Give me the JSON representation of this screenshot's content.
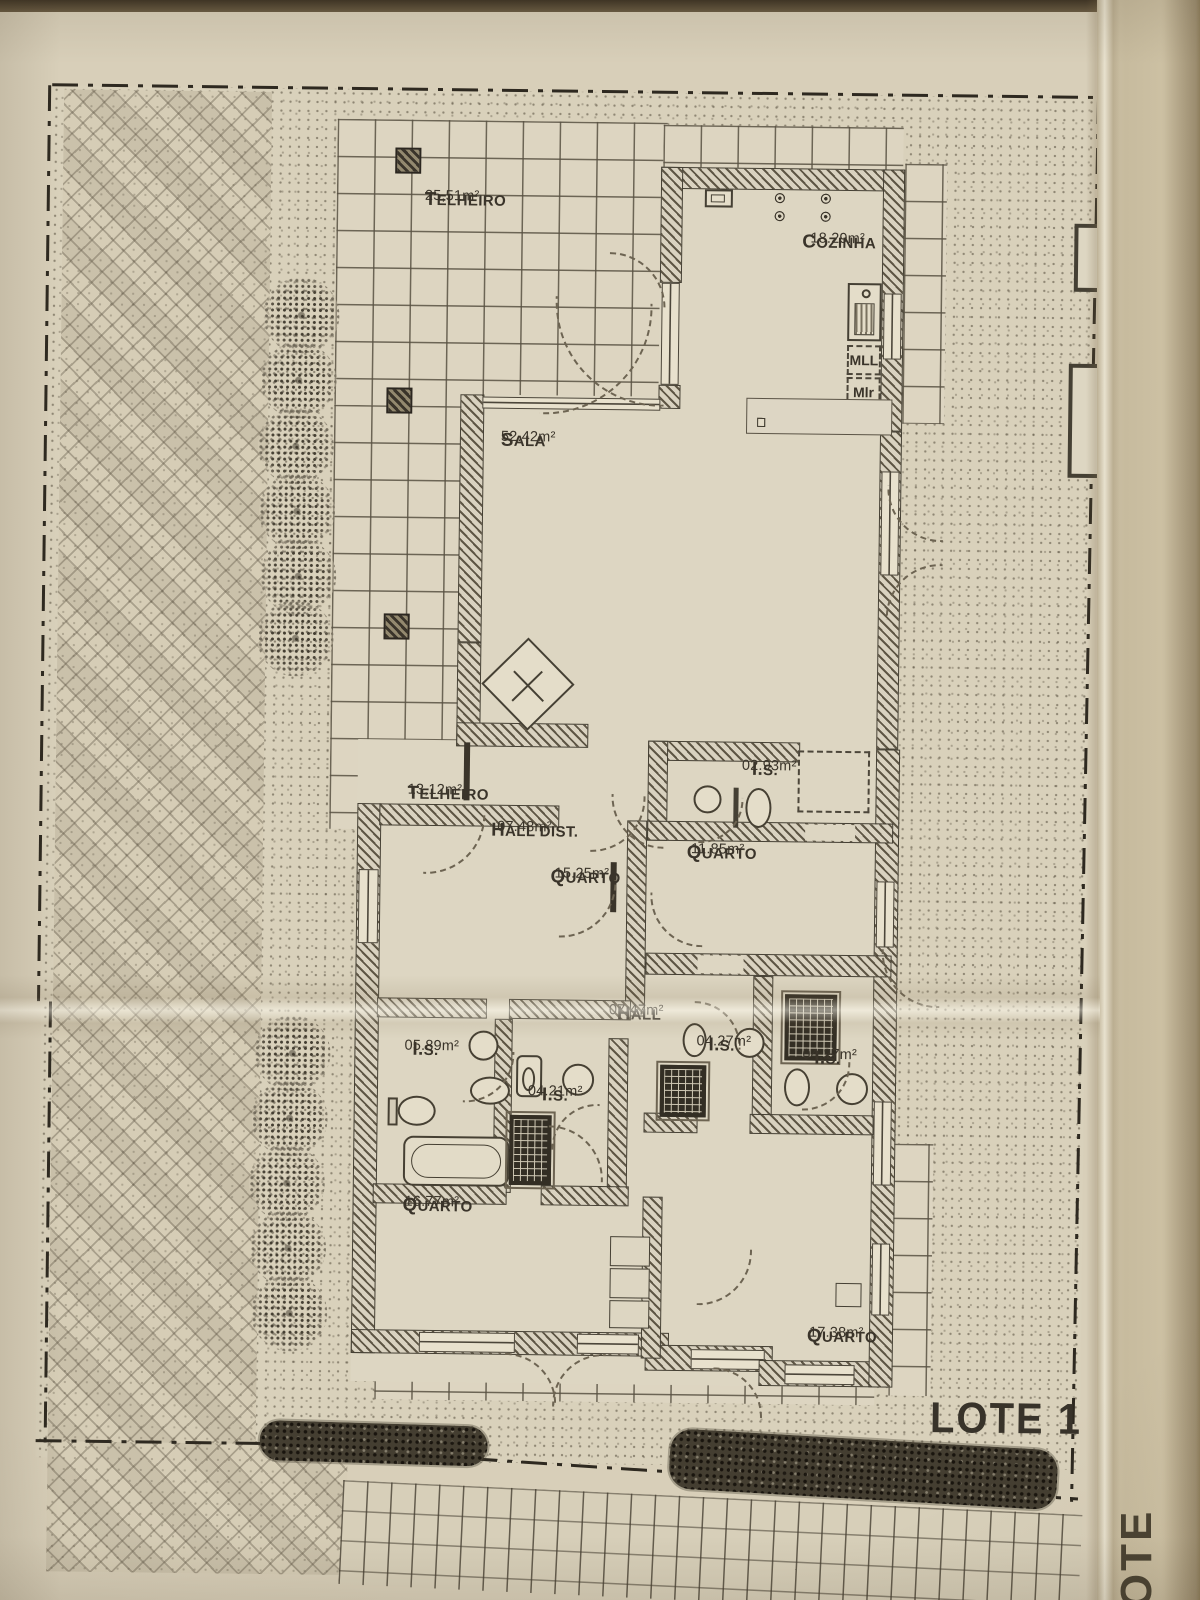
{
  "lots": {
    "current": "LOTE 1",
    "adjacent": "LOTE 2"
  },
  "kitchen": {
    "dishwasher": "MLL",
    "washer": "Mlr"
  },
  "rooms": [
    {
      "id": "telheiro-1",
      "name": "TELHEIRO",
      "area": "25,51m²"
    },
    {
      "id": "cozinha",
      "name": "COZINHA",
      "area": "18.29m²"
    },
    {
      "id": "sala",
      "name": "SALA",
      "area": "52.42m²"
    },
    {
      "id": "telheiro-2",
      "name": "TELHEIRO",
      "area": "13,12m²"
    },
    {
      "id": "hall-dist",
      "name": "HALL DIST.",
      "area": "07.48m²"
    },
    {
      "id": "quarto-1",
      "name": "QUARTO",
      "area": "15.25m²"
    },
    {
      "id": "is-1",
      "name": "I.S.",
      "area": "02.93m²"
    },
    {
      "id": "quarto-2",
      "name": "QUARTO",
      "area": "11.85m²"
    },
    {
      "id": "hall",
      "name": "HALL",
      "area": "07.47m²"
    },
    {
      "id": "is-2",
      "name": "I.S.",
      "area": "05.89m²"
    },
    {
      "id": "is-3",
      "name": "I.S.",
      "area": "04.21m²"
    },
    {
      "id": "is-4",
      "name": "I.S.",
      "area": "04.27m²"
    },
    {
      "id": "is-5",
      "name": "I.S.",
      "area": "04.27m²"
    },
    {
      "id": "quarto-3",
      "name": "QUARTO",
      "area": "16.77m²"
    },
    {
      "id": "quarto-4",
      "name": "QUARTO",
      "area": "17.38m²"
    }
  ],
  "colors": {
    "paper": "#d8cfb9",
    "ink": "#3a342a",
    "boundary": "#2e2920",
    "wall_hatch": "#5e5645"
  }
}
